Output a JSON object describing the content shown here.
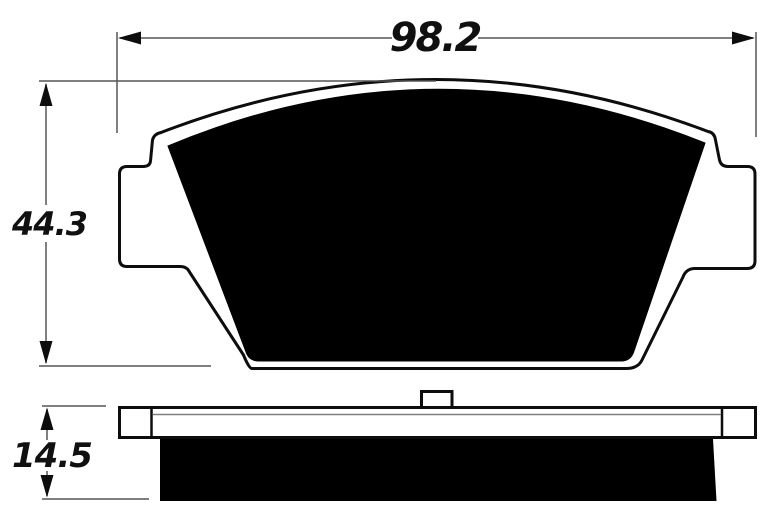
{
  "diagram": {
    "subject": "brake-pad-technical-drawing",
    "views": [
      {
        "name": "front-view"
      },
      {
        "name": "side-view"
      }
    ]
  },
  "dimensions": {
    "width": {
      "label": "98.2"
    },
    "height": {
      "label": "44.3"
    },
    "thickness": {
      "label": "14.5"
    }
  },
  "colors": {
    "background": "#ffffff",
    "outline": "#0d0d0d",
    "fill": "#000000",
    "dimension_line": "#555555",
    "text": "#101010"
  }
}
